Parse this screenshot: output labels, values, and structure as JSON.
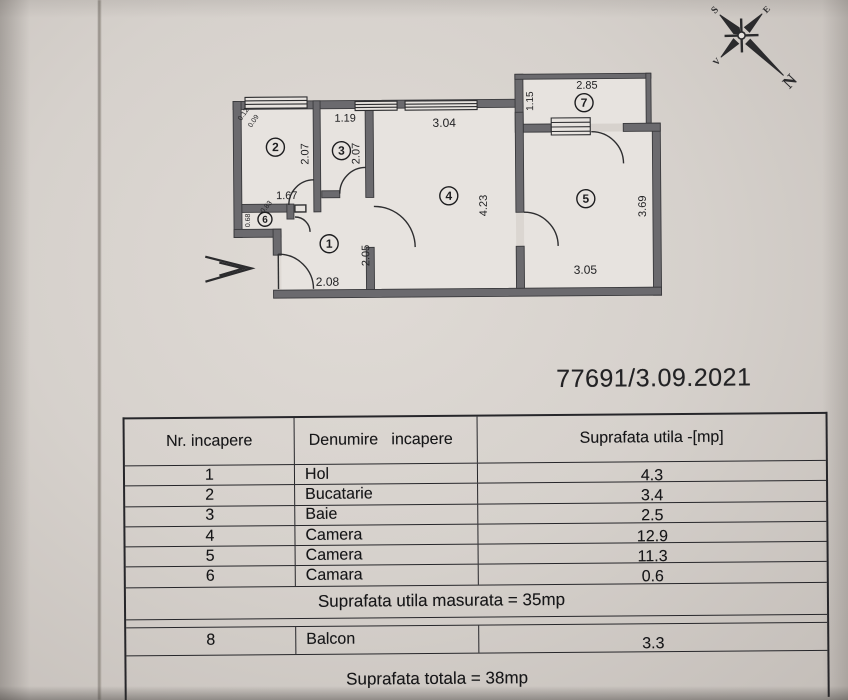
{
  "document": {
    "number": "77691/3.09.2021"
  },
  "compass": {
    "n": "N",
    "s": "S",
    "e": "E",
    "v": "V"
  },
  "plan": {
    "rooms": [
      {
        "n": "1",
        "x": 330,
        "y": 243,
        "r": 9
      },
      {
        "n": "2",
        "x": 277,
        "y": 146,
        "r": 9
      },
      {
        "n": "3",
        "x": 343,
        "y": 150,
        "r": 9
      },
      {
        "n": "4",
        "x": 450,
        "y": 196,
        "r": 9
      },
      {
        "n": "5",
        "x": 587,
        "y": 200,
        "r": 9
      },
      {
        "n": "6",
        "x": 266,
        "y": 218,
        "r": 7
      },
      {
        "n": "7",
        "x": 586,
        "y": 104,
        "r": 9
      }
    ],
    "dimensions": [
      {
        "v": "0.12",
        "x": 247,
        "y": 114,
        "rot": -55,
        "s": 7
      },
      {
        "v": "0.09",
        "x": 257,
        "y": 121,
        "rot": -55,
        "s": 7
      },
      {
        "v": "1.19",
        "x": 347,
        "y": 121,
        "rot": 0,
        "s": 11
      },
      {
        "v": "3.04",
        "x": 446,
        "y": 127,
        "rot": 0,
        "s": 12
      },
      {
        "v": "2.85",
        "x": 589,
        "y": 90,
        "rot": 0,
        "s": 11
      },
      {
        "v": "1.15",
        "x": 535,
        "y": 102,
        "rot": -90,
        "s": 10
      },
      {
        "v": "2.07",
        "x": 310,
        "y": 153,
        "rot": -90,
        "s": 11
      },
      {
        "v": "2.07",
        "x": 361,
        "y": 153,
        "rot": -90,
        "s": 11
      },
      {
        "v": "1.67",
        "x": 288,
        "y": 198,
        "rot": 0,
        "s": 11
      },
      {
        "v": "0.83",
        "x": 269,
        "y": 207,
        "rot": -50,
        "s": 7
      },
      {
        "v": "0.68",
        "x": 251,
        "y": 219,
        "rot": -90,
        "s": 7
      },
      {
        "v": "2.05",
        "x": 370,
        "y": 255,
        "rot": -90,
        "s": 11
      },
      {
        "v": "2.08",
        "x": 328,
        "y": 285,
        "rot": 0,
        "s": 12
      },
      {
        "v": "4.23",
        "x": 488,
        "y": 206,
        "rot": -90,
        "s": 11
      },
      {
        "v": "3.05",
        "x": 586,
        "y": 275,
        "rot": 0,
        "s": 12
      },
      {
        "v": "3.69",
        "x": 647,
        "y": 208,
        "rot": -90,
        "s": 11
      }
    ]
  },
  "table": {
    "headers": [
      "Nr. incapere",
      "Denumire   incapere",
      "Suprafata utila -[mp]"
    ],
    "rows": [
      {
        "nr": "1",
        "name": "Hol",
        "area": "4.3"
      },
      {
        "nr": "2",
        "name": "Bucatarie",
        "area": "3.4"
      },
      {
        "nr": "3",
        "name": "Baie",
        "area": "2.5"
      },
      {
        "nr": "4",
        "name": "Camera",
        "area": "12.9"
      },
      {
        "nr": "5",
        "name": "Camera",
        "area": "11.3"
      },
      {
        "nr": "6",
        "name": "Camara",
        "area": "0.6"
      }
    ],
    "summary_utila": "Suprafata utila masurata = 35mp",
    "balcon_row": {
      "nr": "8",
      "name": "Balcon",
      "area": "3.3"
    },
    "summary_total": "Suprafata totala = 38mp"
  },
  "colors": {
    "paper": "#d6d1cc",
    "wall": "#6b6a6e",
    "ink": "#1c1c1e"
  }
}
